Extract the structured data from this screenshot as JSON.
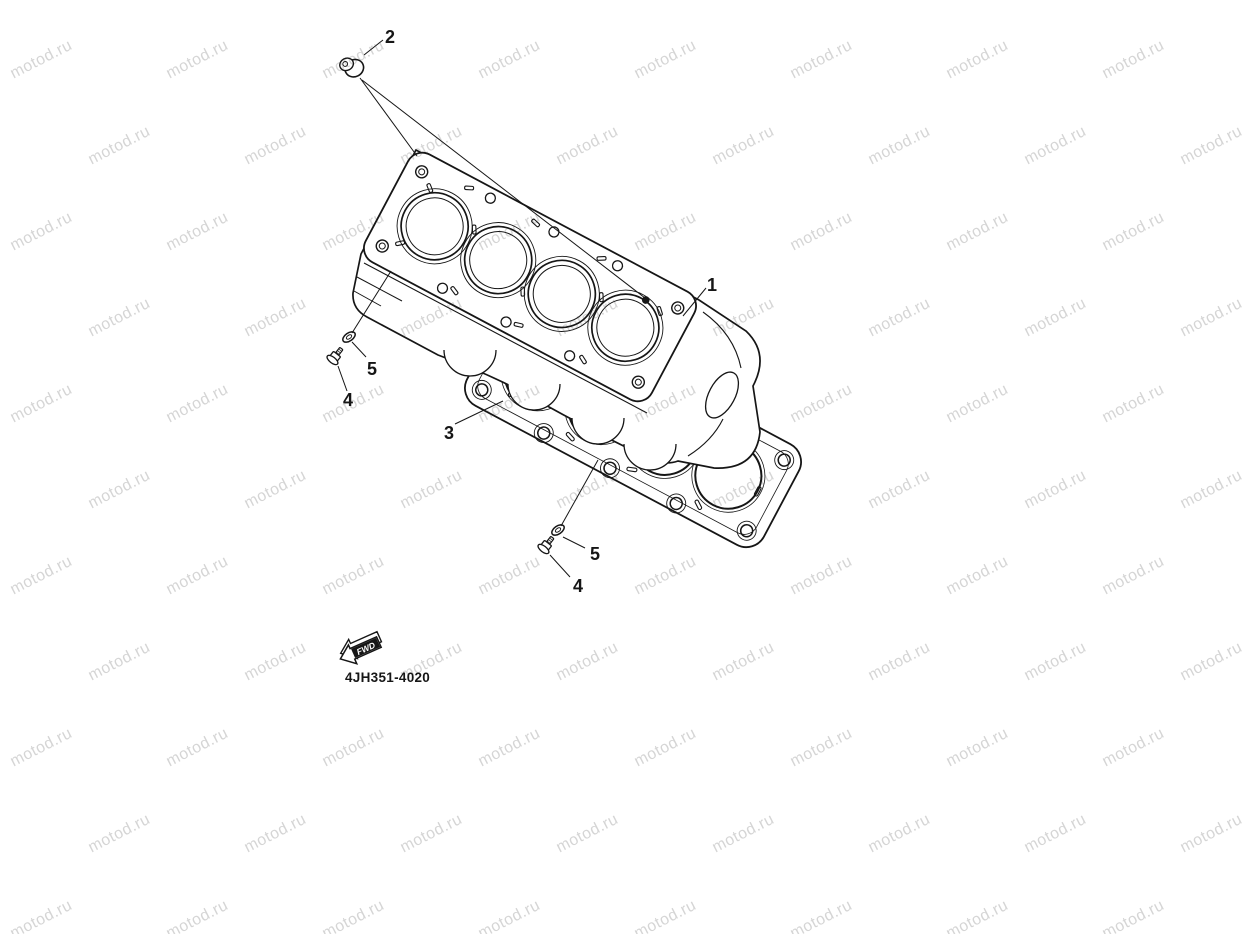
{
  "page": {
    "background": "#ffffff",
    "line_color": "#161616"
  },
  "watermark": {
    "text": "motod.ru",
    "color": "#d5d5d5"
  },
  "diagram": {
    "drawing_code": "4JH351-4020",
    "fwd_arrow_label": "FWD",
    "callouts": {
      "part1": "1",
      "part2": "2",
      "part3": "3",
      "part4_upper": "4",
      "part5_upper": "5",
      "part4_lower": "4",
      "part5_lower": "5"
    }
  }
}
